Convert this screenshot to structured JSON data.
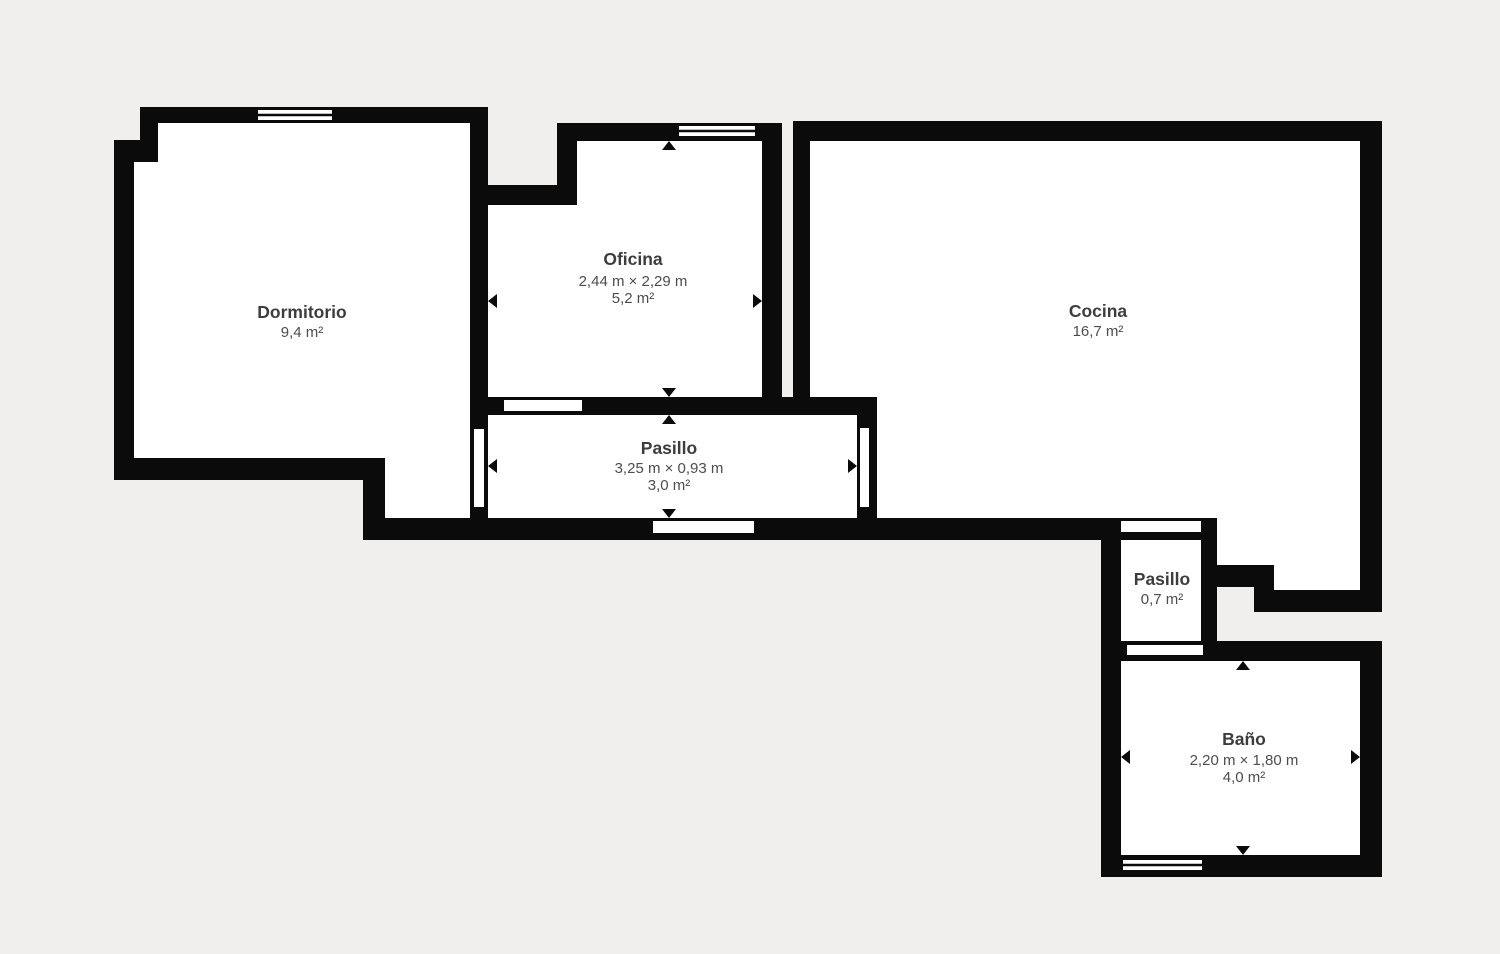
{
  "canvas": {
    "width": 1500,
    "height": 954,
    "background_color": "#f1efed",
    "wall_color": "#0b0b0b",
    "room_fill_color": "#ffffff",
    "label_title_color": "#3d3d3d",
    "label_sub_color": "#4d4d4d"
  },
  "floorplan": {
    "rooms": [
      {
        "id": "dormitorio",
        "name": "Dormitorio",
        "dims": null,
        "area": "9,4 m²",
        "label": {
          "x": 302,
          "title_y": 318,
          "dims_y": null,
          "area_y": 337
        },
        "interior": "156,119 472,119 472,522 383,522 383,460 132,460 132,160 156,160"
      },
      {
        "id": "oficina",
        "name": "Oficina",
        "dims": "2,44 m × 2,29 m",
        "area": "5,2 m²",
        "label": {
          "x": 633,
          "title_y": 265,
          "dims_y": 286,
          "area_y": 303
        },
        "interior": "575,139 764,139 764,401 486,401 486,203 575,203"
      },
      {
        "id": "cocina",
        "name": "Cocina",
        "dims": null,
        "area": "16,7 m²",
        "label": {
          "x": 1098,
          "title_y": 317,
          "dims_y": null,
          "area_y": 336
        },
        "interior": "808,141 1362,141 1362,592 1272,592 1272,567 1215,567 1215,520 875,520 875,413 808,413"
      },
      {
        "id": "pasillo",
        "name": "Pasillo",
        "dims": "3,25 m × 0,93 m",
        "area": "3,0 m²",
        "label": {
          "x": 669,
          "title_y": 454,
          "dims_y": 473,
          "area_y": 490
        },
        "interior": "486,411 861,411 861,524 486,524"
      },
      {
        "id": "pasillo-2",
        "name": "Pasillo",
        "dims": null,
        "area": "0,7 m²",
        "label": {
          "x": 1162,
          "title_y": 585,
          "dims_y": null,
          "area_y": 604
        },
        "interior": "1117,534 1205,534 1205,649 1117,649"
      },
      {
        "id": "bano",
        "name": "Baño",
        "dims": "2,20 m × 1,80 m",
        "area": "4,0 m²",
        "label": {
          "x": 1244,
          "title_y": 745,
          "dims_y": 765,
          "area_y": 782
        },
        "interior": "1117,655 1364,655 1364,859 1117,859"
      }
    ],
    "walls": [
      {
        "x": 140,
        "y": 107,
        "w": 348,
        "h": 16
      },
      {
        "x": 140,
        "y": 107,
        "w": 18,
        "h": 55
      },
      {
        "x": 114,
        "y": 140,
        "w": 44,
        "h": 22
      },
      {
        "x": 114,
        "y": 140,
        "w": 20,
        "h": 340
      },
      {
        "x": 114,
        "y": 458,
        "w": 271,
        "h": 22
      },
      {
        "x": 363,
        "y": 458,
        "w": 22,
        "h": 82
      },
      {
        "x": 363,
        "y": 518,
        "w": 854,
        "h": 22
      },
      {
        "x": 470,
        "y": 107,
        "w": 18,
        "h": 433
      },
      {
        "x": 470,
        "y": 185,
        "w": 107,
        "h": 20
      },
      {
        "x": 557,
        "y": 123,
        "w": 20,
        "h": 82
      },
      {
        "x": 557,
        "y": 123,
        "w": 225,
        "h": 18
      },
      {
        "x": 762,
        "y": 123,
        "w": 20,
        "h": 292
      },
      {
        "x": 470,
        "y": 397,
        "w": 407,
        "h": 18
      },
      {
        "x": 857,
        "y": 397,
        "w": 20,
        "h": 143
      },
      {
        "x": 793,
        "y": 123,
        "w": 17,
        "h": 292
      },
      {
        "x": 793,
        "y": 121,
        "w": 589,
        "h": 20
      },
      {
        "x": 1360,
        "y": 121,
        "w": 22,
        "h": 491
      },
      {
        "x": 1215,
        "y": 565,
        "w": 59,
        "h": 22
      },
      {
        "x": 1254,
        "y": 565,
        "w": 20,
        "h": 47
      },
      {
        "x": 1254,
        "y": 590,
        "w": 128,
        "h": 22
      },
      {
        "x": 1201,
        "y": 518,
        "w": 16,
        "h": 143
      },
      {
        "x": 1101,
        "y": 518,
        "w": 20,
        "h": 359
      },
      {
        "x": 1101,
        "y": 641,
        "w": 281,
        "h": 20
      },
      {
        "x": 1360,
        "y": 641,
        "w": 22,
        "h": 236
      },
      {
        "x": 1101,
        "y": 855,
        "w": 281,
        "h": 22
      }
    ],
    "doors": [
      {
        "x": 473,
        "y": 428,
        "w": 12,
        "h": 80
      },
      {
        "x": 503,
        "y": 399,
        "w": 80,
        "h": 13
      },
      {
        "x": 652,
        "y": 520,
        "w": 103,
        "h": 14
      },
      {
        "x": 859,
        "y": 427,
        "w": 11,
        "h": 81
      },
      {
        "x": 1120,
        "y": 520,
        "w": 82,
        "h": 13
      },
      {
        "x": 1126,
        "y": 644,
        "w": 78,
        "h": 12
      }
    ],
    "windows": [
      {
        "x": 257,
        "y": 109,
        "w": 76,
        "h": 12
      },
      {
        "x": 678,
        "y": 125,
        "w": 78,
        "h": 12
      },
      {
        "x": 1122,
        "y": 859,
        "w": 81,
        "h": 12
      }
    ],
    "arrows": [
      {
        "x": 488,
        "y": 301,
        "dir": "left"
      },
      {
        "x": 762,
        "y": 301,
        "dir": "right"
      },
      {
        "x": 669,
        "y": 141,
        "dir": "up"
      },
      {
        "x": 669,
        "y": 397,
        "dir": "down"
      },
      {
        "x": 488,
        "y": 466,
        "dir": "left"
      },
      {
        "x": 857,
        "y": 466,
        "dir": "right"
      },
      {
        "x": 669,
        "y": 415,
        "dir": "up"
      },
      {
        "x": 669,
        "y": 518,
        "dir": "down"
      },
      {
        "x": 1121,
        "y": 757,
        "dir": "left"
      },
      {
        "x": 1360,
        "y": 757,
        "dir": "right"
      },
      {
        "x": 1243,
        "y": 661,
        "dir": "up"
      },
      {
        "x": 1243,
        "y": 855,
        "dir": "down"
      }
    ]
  }
}
